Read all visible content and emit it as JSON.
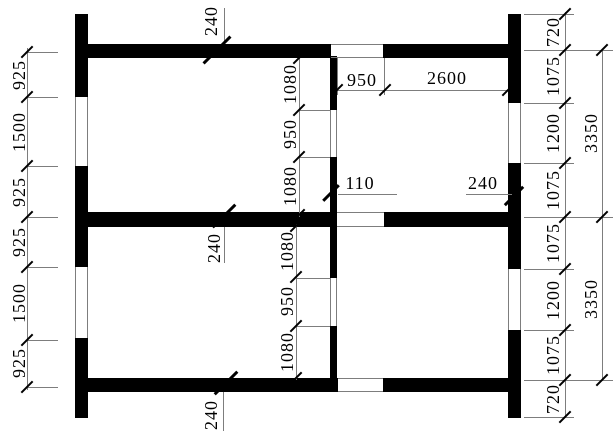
{
  "dims": {
    "left": [
      "925",
      "1500",
      "925",
      "925",
      "1500",
      "925"
    ],
    "right_inner": [
      "720",
      "1075",
      "1200",
      "1075",
      "1075",
      "1200",
      "1075",
      "720"
    ],
    "right_outer": [
      "3350",
      "3350"
    ],
    "interior_top": [
      "1080",
      "950",
      "1080"
    ],
    "interior_bottom": [
      "1080",
      "950",
      "1080"
    ],
    "top_width": [
      "950",
      "2600"
    ],
    "thickness": {
      "top_wall": "240",
      "middle_wall": "240",
      "bottom_wall": "240",
      "right_wall": "240",
      "partition": "110"
    }
  }
}
